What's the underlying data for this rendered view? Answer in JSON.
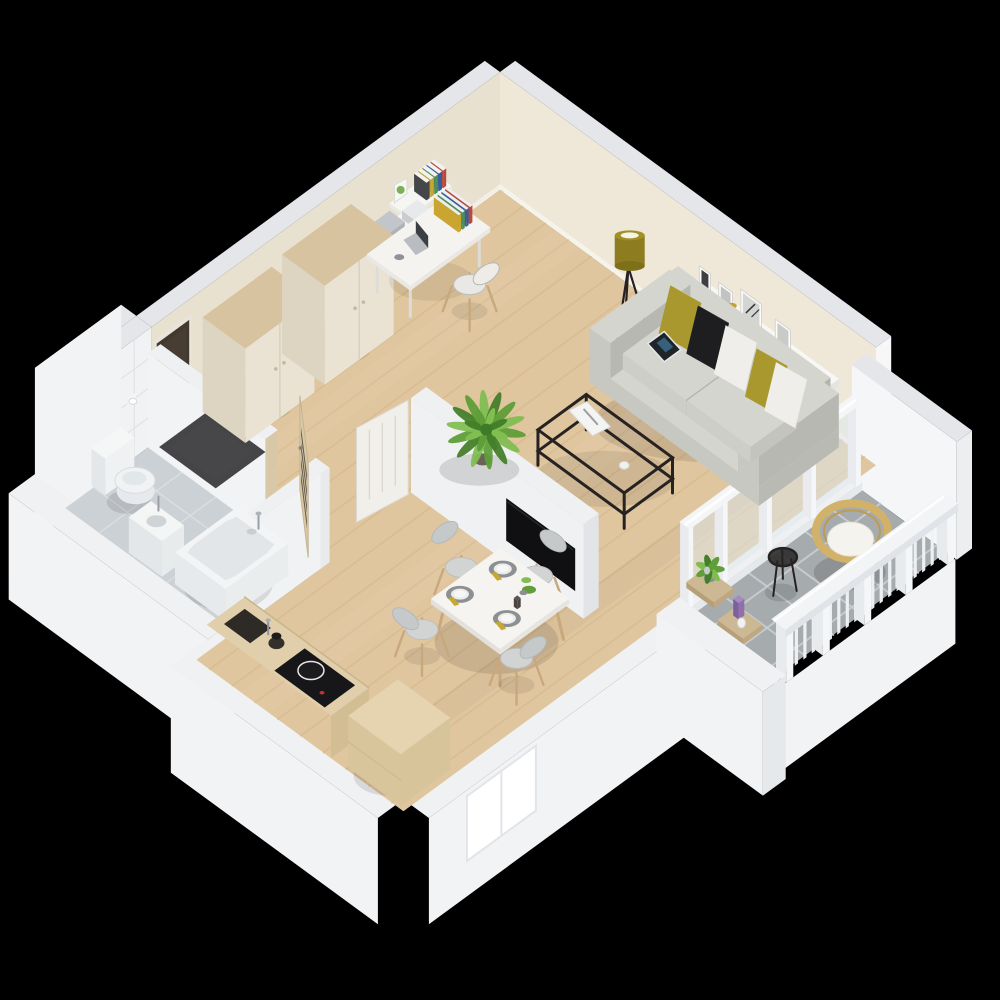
{
  "scene": {
    "description": "Isometric 3D rendering of a studio apartment floor plan on a black background",
    "background": "#000000",
    "rooms": [
      {
        "id": "living-room",
        "floor": "light oak wood"
      },
      {
        "id": "hallway",
        "floor": "light oak wood"
      },
      {
        "id": "kitchen-dining",
        "floor": "light oak wood"
      },
      {
        "id": "bathroom",
        "floor": "light gray tile"
      },
      {
        "id": "balcony",
        "floor": "gray tile"
      }
    ],
    "objects": [
      {
        "id": "wall-north-east",
        "label": "exterior wall, cream interior face"
      },
      {
        "id": "living-wall-shelf",
        "label": "white wall shelf with picture frames and decor"
      },
      {
        "id": "wall-north-west",
        "label": "exterior wall, cream interior face"
      },
      {
        "id": "entrance-door",
        "label": "dark brown entrance door"
      },
      {
        "id": "desk-wall-shelves",
        "label": "wall shelves with books above desk"
      },
      {
        "id": "wall-west-bathroom",
        "label": "white tiled bathroom wall"
      },
      {
        "id": "wall-south-west",
        "label": "exterior wall band"
      },
      {
        "id": "wall-south-east",
        "label": "exterior wall with bright kitchen window"
      },
      {
        "id": "balcony-wall-north",
        "label": "solid balcony end wall"
      },
      {
        "id": "wood-floor",
        "label": "oak plank flooring"
      },
      {
        "id": "bathroom-floor",
        "label": "gray tiled bathroom floor"
      },
      {
        "id": "balcony-floor",
        "label": "gray tiled balcony floor"
      },
      {
        "id": "balcony-glazing",
        "label": "glass wall between living room and balcony"
      },
      {
        "id": "bathroom-partition-walls",
        "label": "bathroom partition walls with doorway"
      },
      {
        "id": "doormat",
        "label": "dark entry doormat"
      },
      {
        "id": "wardrobe-left",
        "label": "cream wardrobe with wood top"
      },
      {
        "id": "wardrobe-right",
        "label": "cream wardrobe with wood top"
      },
      {
        "id": "bathroom-door-open",
        "label": "open wooden door with dark glass panes"
      },
      {
        "id": "desk",
        "label": "white desk with laptop and books"
      },
      {
        "id": "desk-chair",
        "label": "white chair with wooden legs"
      },
      {
        "id": "floor-lamp",
        "label": "floor lamp with olive shade"
      },
      {
        "id": "sofa",
        "label": "gray sofa with olive, black and white pillows and tablet"
      },
      {
        "id": "coffee-table",
        "label": "black metal frame coffee table with magazine"
      },
      {
        "id": "partition-wall",
        "label": "freestanding partition wall"
      },
      {
        "id": "tv",
        "label": "flat screen TV on partition"
      },
      {
        "id": "partition-door",
        "label": "white interior door, open"
      },
      {
        "id": "palm-plant",
        "label": "green palm plant"
      },
      {
        "id": "toilet",
        "label": "white toilet"
      },
      {
        "id": "toilet-paper-holder",
        "label": "toilet paper holder"
      },
      {
        "id": "washbasin",
        "label": "small white washbasin"
      },
      {
        "id": "bathtub",
        "label": "white bathtub with chrome mixer"
      },
      {
        "id": "dining-chair-north",
        "label": "gray dining chair"
      },
      {
        "id": "dining-chair-west",
        "label": "gray dining chair"
      },
      {
        "id": "dining-table",
        "label": "white dining table with place settings"
      },
      {
        "id": "dining-chair-south",
        "label": "gray dining chair"
      },
      {
        "id": "dining-chair-east",
        "label": "gray dining chair"
      },
      {
        "id": "kitchen-counter",
        "label": "wood kitchen counter with sink, kettle and cooktop"
      },
      {
        "id": "kitchen-island",
        "label": "light wood kitchen cabinet block"
      },
      {
        "id": "balcony-side-table",
        "label": "black round side table"
      },
      {
        "id": "balcony-chair",
        "label": "rattan chair with white cushion"
      },
      {
        "id": "balcony-plant-stand",
        "label": "plant stand with green plant and candle"
      },
      {
        "id": "balcony-railing",
        "label": "white balcony railing with balusters"
      },
      {
        "id": "balcony-wall-south",
        "label": "solid balcony end wall"
      }
    ]
  },
  "palette": {
    "background": "#000000",
    "wallTop": "#e4e6ea",
    "wallOuter": "#f2f3f5",
    "wallCream": "#efe8d9",
    "wallCreamDark": "#e9e1cf",
    "bathWallTile": "#f0f2f3",
    "bathTileLine": "#e0e4e6",
    "bathFloor": "#ccd1d5",
    "bathGrout": "#dde1e4",
    "floorWood": "#e0c69f",
    "floorWoodStripe": "#d2b587",
    "balconyTile": "#a6abae",
    "balconyGrout": "#c9cdd1",
    "partitionFace": "#f0f1f3",
    "mat": "#3b3b3d",
    "wardrobe": "#eae3d4",
    "wardrobeSide": "#ddd4c2",
    "woodTop": "#d7c3a0",
    "doorDark": "#42382c",
    "doorWood": "#d9c8a7",
    "doorPane": "#4c463c",
    "doorWhite": "#f1efe9",
    "desk": "#f4f3f0",
    "chairSeat": "#e9e8e4",
    "legWood": "#c8a87c",
    "sofa": "#c7c8c2",
    "sofaLight": "#d4d5cf",
    "sofaShade": "#b4b5af",
    "pillowOlive": "#a8982d",
    "pillowBlack": "#1e1e20",
    "pillowWhite": "#efeeea",
    "lampOlive": "#8d7d20",
    "metalBlack": "#262222",
    "shelfWhite": "#f5f5f2",
    "tv": "#101012",
    "plantGreen": "#5f9e38",
    "plantGreenLight": "#82bd52",
    "plantGreenDark": "#447f2a",
    "tableWhite": "#f5f4f1",
    "matGray": "#8d9093",
    "plate": "#ececea",
    "napkin": "#c7a92f",
    "counterWood": "#e1ceaa",
    "counterFront": "#d3bd93",
    "sink": "#2e2b27",
    "cooktop": "#17171a",
    "islandWood": "#e6d4b0",
    "islandSide": "#d9c59c",
    "tub": "#f2f4f5",
    "tubInner": "#e2e6e9",
    "toilet": "#f0f2f3",
    "rattan": "#d2b169",
    "rattanDark": "#bd9b52",
    "cushion": "#f4f3ee",
    "railing": "#f0f2f5",
    "glass": "#dde8ed",
    "window": "#ffffff"
  }
}
